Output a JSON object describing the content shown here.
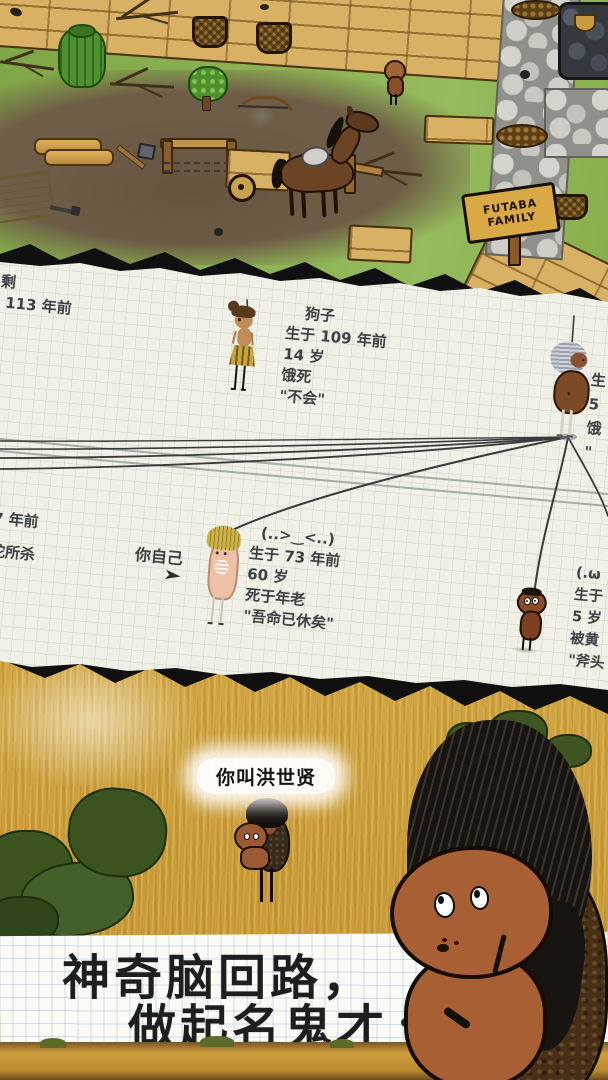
{
  "top_scene": {
    "sign_line1": "FUTABA",
    "sign_line2": "FAMILY"
  },
  "family_tree": {
    "left_top_partial": {
      "lines": [
        "剩",
        "于 113 年前",
        "岁",
        "死"
      ]
    },
    "gouzi": {
      "lines": [
        "狗子",
        "生于 109 年前",
        "14 岁",
        "饿死",
        "\"不会\""
      ]
    },
    "right_elder_partial": {
      "lines": [
        "生",
        "5",
        "饿",
        "\""
      ]
    },
    "left_mid_partial": {
      "lines": [
        "7 年前",
        "蛇所杀"
      ]
    },
    "you_label": "你自己",
    "you_arrow": "➤",
    "you": {
      "lines": [
        "(..>‿<..)",
        "生于 73 年前",
        "60 岁",
        "死于年老",
        "\"吾命已休矣\""
      ]
    },
    "right_child_partial": {
      "lines": [
        "(.ω",
        "生于",
        "5 岁",
        "被黄",
        "\"斧头"
      ]
    }
  },
  "bottom_scene": {
    "name_popup": "你叫洪世贤",
    "caption_line1": "神奇脑回路，",
    "caption_line2": "做起名鬼才 ."
  },
  "colors": {
    "paper": "#f1f0e6",
    "paper_grid": "#c5d3c4",
    "banner_grid": "#8cafd7",
    "ink": "#3c4144",
    "field_gold": "#cda03e",
    "grass_green": "#85ab4c"
  }
}
